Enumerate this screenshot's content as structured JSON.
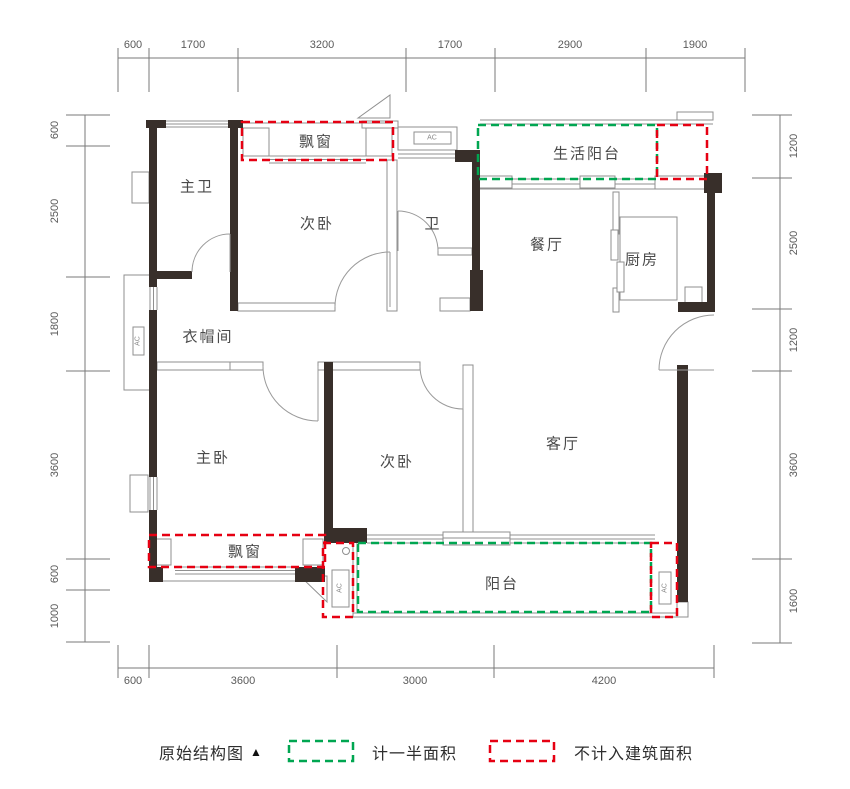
{
  "plan": {
    "rooms": {
      "master_bath": "主卫",
      "bedroom_top": "次卧",
      "bay_top": "飘窗",
      "bath": "卫",
      "dining": "餐厅",
      "kitchen": "厨房",
      "service_balcony": "生活阳台",
      "cloakroom": "衣帽间",
      "master_bedroom": "主卧",
      "bedroom_bottom": "次卧",
      "living": "客厅",
      "balcony": "阳台",
      "bay_bottom": "飘窗"
    },
    "ac_label": "AC"
  },
  "dims": {
    "top": [
      "600",
      "1700",
      "3200",
      "1700",
      "2900",
      "1900"
    ],
    "left": [
      "600",
      "2500",
      "1800",
      "3600",
      "600",
      "1000"
    ],
    "right": [
      "1200",
      "2500",
      "1200",
      "3600",
      "1600"
    ],
    "bottom": [
      "600",
      "3600",
      "3000",
      "4200"
    ]
  },
  "legend": {
    "title": "原始结构图",
    "title_marker": "▲",
    "half_area": "计一半面积",
    "excluded_area": "不计入建筑面积"
  },
  "colors": {
    "wall": "#382f2a",
    "thin_line": "#8f8f8f",
    "half_area_green": "#00a651",
    "excluded_red": "#e60012"
  }
}
